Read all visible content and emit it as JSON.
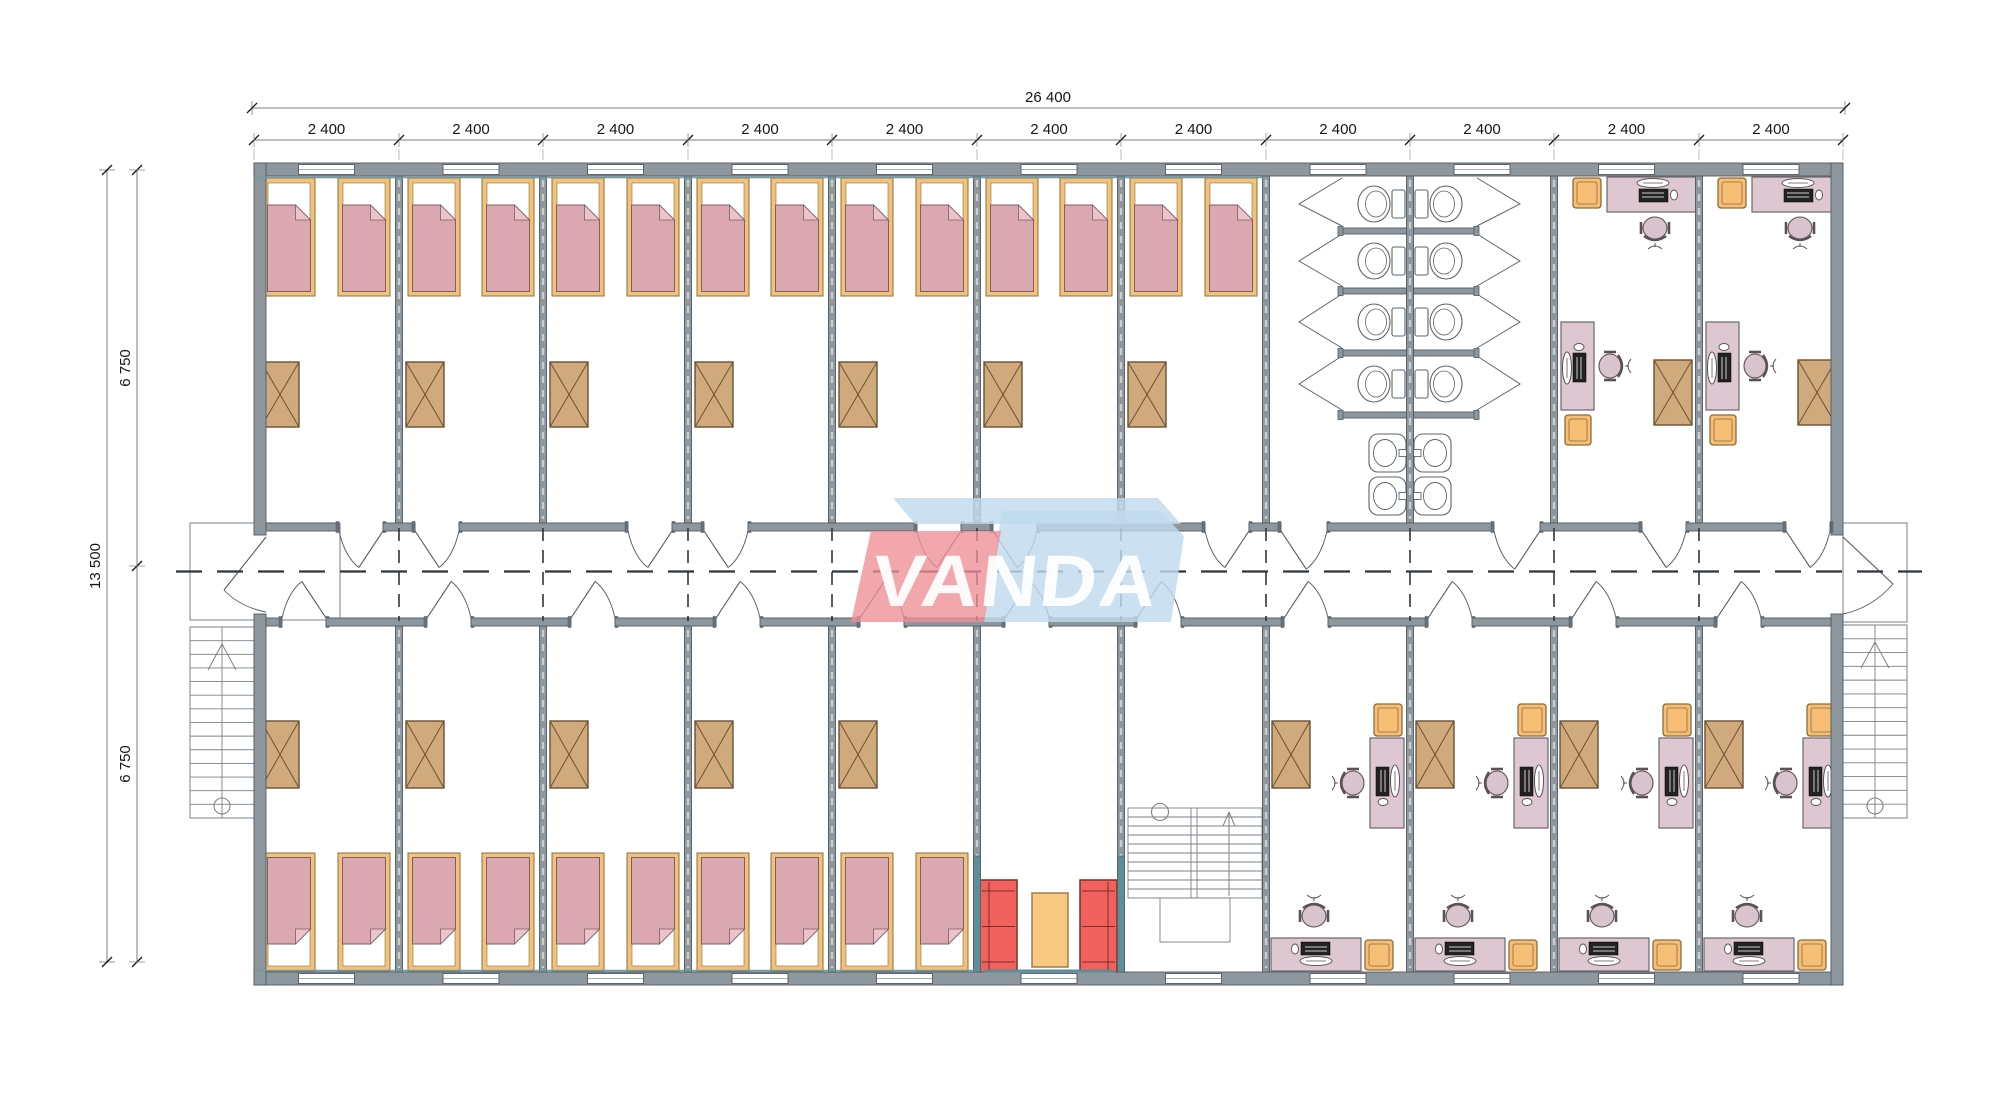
{
  "drawing": {
    "title": "modular dormitory floor plan",
    "logo_text": "VANDA",
    "dimensions": {
      "top": {
        "total": "26 400",
        "segments": [
          "2 400",
          "2 400",
          "2 400",
          "2 400",
          "2 400",
          "2 400",
          "2 400",
          "2 400",
          "2 400",
          "2 400",
          "2 400"
        ]
      },
      "left": {
        "total": "13 500",
        "halves": [
          "6 750",
          "6 750"
        ]
      }
    },
    "rooms_top": [
      "bedroom",
      "bedroom",
      "bedroom",
      "bedroom",
      "bedroom",
      "bedroom",
      "bedroom",
      "sanitary",
      "sanitary",
      "office",
      "office"
    ],
    "rooms_bottom": [
      "bedroom",
      "bedroom",
      "bedroom",
      "bedroom",
      "bedroom",
      "lounge",
      "stairwell",
      "office",
      "office",
      "office",
      "office"
    ],
    "furniture_icons": [
      "bed-icon",
      "wardrobe-icon",
      "desk-icon",
      "office-chair-icon",
      "visitor-chair-icon",
      "sofa-icon",
      "coffee-table-icon",
      "toilet-icon",
      "sink-icon",
      "stairs-icon"
    ],
    "colors": {
      "wall": "#8e979d",
      "wall_dark": "#4f5a62",
      "bed_frame": "#f2c279",
      "bed_frame_line": "#8a6d3f",
      "blanket": "#dba8b1",
      "blanket_line": "#7c5f66",
      "fold": "#ecc3ca",
      "wardrobe": "#d0a97d",
      "wardrobe_line": "#6d5130",
      "desk": "#ddc7d0",
      "desk_line": "#6f666b",
      "chair_seat": "#d9c3cc",
      "chair_line": "#5b5257",
      "orange_chair": "#f7be75",
      "orange_line": "#8c6b3b",
      "sofa": "#f1625f",
      "sofa_line": "#7c2e27",
      "table": "#f9c981",
      "table_line": "#a07c45",
      "fixture_line": "#5c6569",
      "stair_line": "#7b8287",
      "axis": "#2e353b",
      "dim_line": "#787d80",
      "dim_text": "#141617",
      "teal": "#5e8e97",
      "logo_red": "#ee8e96",
      "logo_blue": "#c0dbee",
      "logo_text_color": "#ffffff"
    }
  }
}
